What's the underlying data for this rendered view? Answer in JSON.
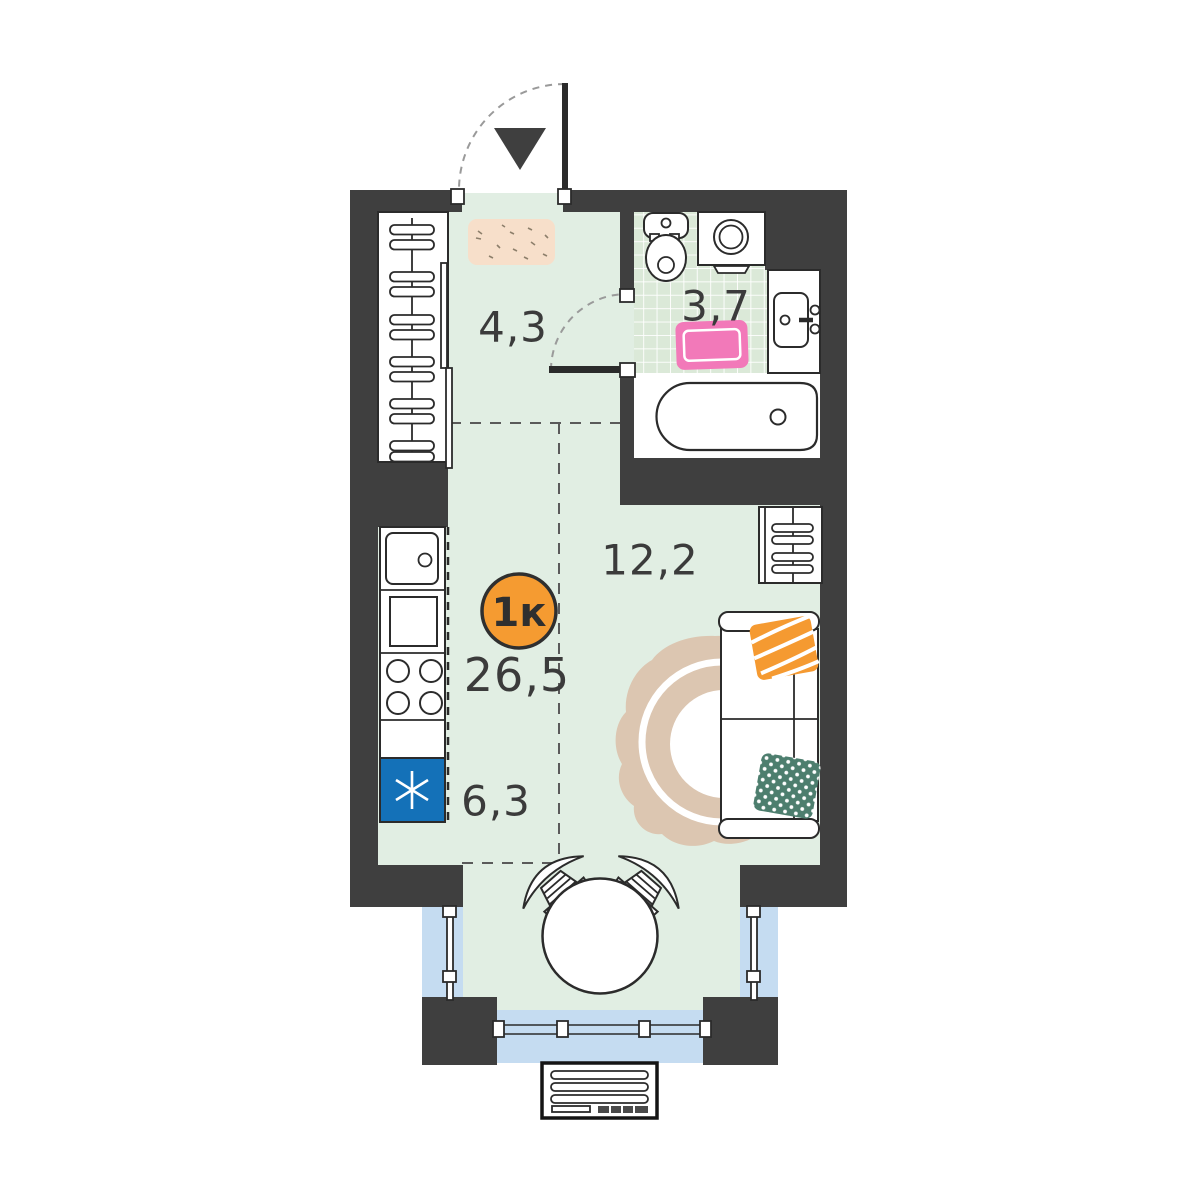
{
  "plan": {
    "badge": {
      "label": "1к"
    },
    "areas": {
      "total": "26,5",
      "hallway": "4,3",
      "bathroom": "3,7",
      "living": "12,2",
      "kitchen": "6,3"
    },
    "colors": {
      "wall": "#3f3f3f",
      "floor": "#e1eee3",
      "tile": "#dbe9d8",
      "glass": "#c5dcf1",
      "badge": "#f59b31",
      "fridge": "#1471b8",
      "hall_rug": "#f7dfca",
      "bath_rug": "#f279b9",
      "living_rug": "#dcc6b1",
      "pillow_orange": "#f59a31",
      "pillow_green": "#4d7e6e",
      "label": "#3b3b3b"
    }
  }
}
